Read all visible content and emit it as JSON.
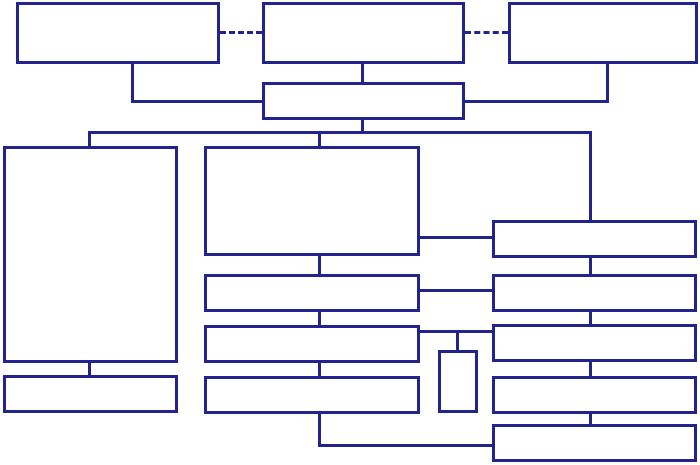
{
  "diagram": {
    "type": "flowchart-template",
    "title": "",
    "background_color": "#ffffff",
    "line_color": "#23238d",
    "line_width_px": 3,
    "nodes": [
      {
        "id": "top-left",
        "label": ""
      },
      {
        "id": "top-center",
        "label": ""
      },
      {
        "id": "top-right",
        "label": ""
      },
      {
        "id": "hub",
        "label": ""
      },
      {
        "id": "left-panel",
        "label": ""
      },
      {
        "id": "left-footer",
        "label": ""
      },
      {
        "id": "main-panel",
        "label": ""
      },
      {
        "id": "mid-row-2",
        "label": ""
      },
      {
        "id": "mid-row-3",
        "label": ""
      },
      {
        "id": "mid-row-4",
        "label": ""
      },
      {
        "id": "pendant",
        "label": ""
      },
      {
        "id": "right-row-1",
        "label": ""
      },
      {
        "id": "right-row-2",
        "label": ""
      },
      {
        "id": "right-row-3",
        "label": ""
      },
      {
        "id": "right-row-4",
        "label": ""
      },
      {
        "id": "right-row-5",
        "label": ""
      }
    ],
    "edges": [
      {
        "from": "top-left",
        "to": "top-center",
        "style": "dashed"
      },
      {
        "from": "top-center",
        "to": "top-right",
        "style": "dashed"
      },
      {
        "from": "top-left",
        "to": "hub",
        "style": "elbow"
      },
      {
        "from": "top-center",
        "to": "hub",
        "style": "straight"
      },
      {
        "from": "top-right",
        "to": "hub",
        "style": "elbow"
      },
      {
        "from": "hub",
        "to": "left-panel",
        "style": "bus"
      },
      {
        "from": "hub",
        "to": "main-panel",
        "style": "bus"
      },
      {
        "from": "hub",
        "to": "right-row-1",
        "style": "bus"
      },
      {
        "from": "left-panel",
        "to": "left-footer",
        "style": "straight"
      },
      {
        "from": "main-panel",
        "to": "mid-row-2",
        "style": "straight"
      },
      {
        "from": "mid-row-2",
        "to": "mid-row-3",
        "style": "straight"
      },
      {
        "from": "mid-row-3",
        "to": "mid-row-4",
        "style": "straight"
      },
      {
        "from": "main-panel",
        "to": "right-row-1",
        "style": "straight"
      },
      {
        "from": "mid-row-2",
        "to": "right-row-2",
        "style": "straight"
      },
      {
        "from": "mid-row-3",
        "to": "right-row-3",
        "style": "straight"
      },
      {
        "from": "mid-row-3",
        "to": "pendant",
        "style": "drop"
      },
      {
        "from": "mid-row-4",
        "to": "right-row-5",
        "style": "elbow"
      },
      {
        "from": "right-row-1",
        "to": "right-row-2",
        "style": "straight"
      },
      {
        "from": "right-row-2",
        "to": "right-row-3",
        "style": "straight"
      },
      {
        "from": "right-row-3",
        "to": "right-row-4",
        "style": "straight"
      },
      {
        "from": "right-row-4",
        "to": "right-row-5",
        "style": "straight"
      }
    ]
  }
}
